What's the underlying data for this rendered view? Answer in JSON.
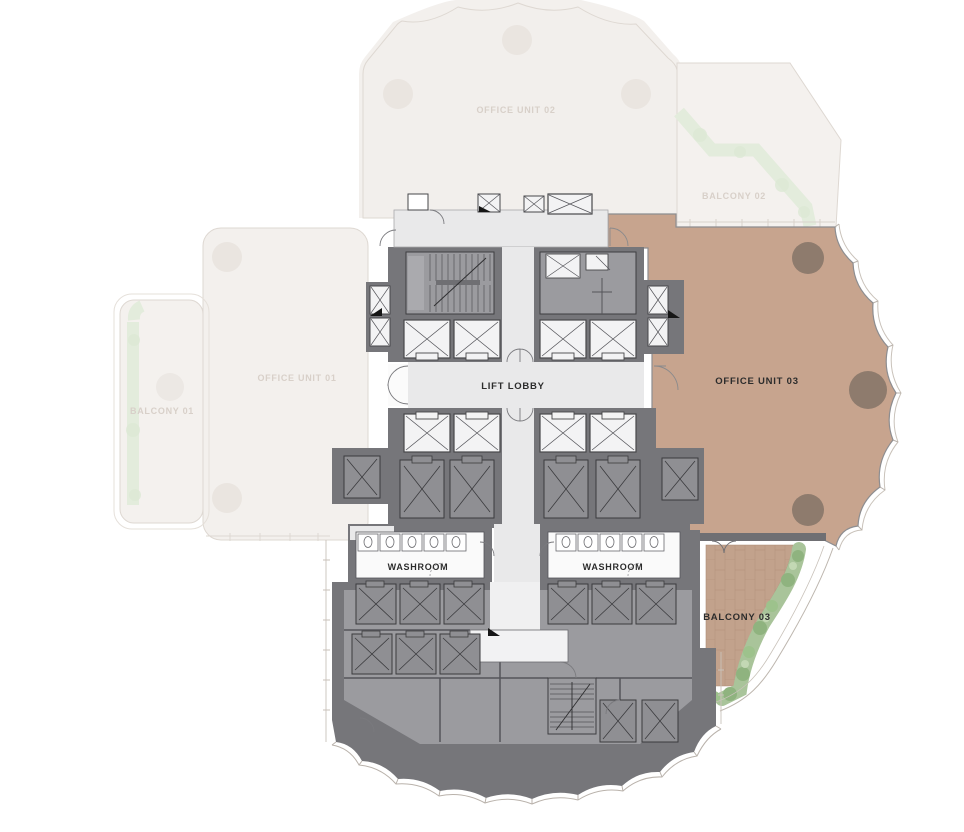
{
  "plan": {
    "type": "office-floor-plan",
    "rooms": {
      "office_unit_01": "OFFICE UNIT 01",
      "office_unit_02": "OFFICE UNIT 02",
      "office_unit_03": "OFFICE UNIT 03",
      "balcony_01": "BALCONY 01",
      "balcony_02": "BALCONY 02",
      "balcony_03": "BALCONY 03",
      "lift_lobby": "LIFT LOBBY",
      "washroom": "WASHROOM"
    },
    "highlighted_unit": "OFFICE UNIT 03",
    "colors": {
      "highlight_unit": "#c7a48e",
      "unit_column": "#8e7b6d",
      "balcony_tile": "#c2a28c",
      "plant_green": "#9cbb8d",
      "plant_green_dark": "#8fb37f",
      "core_wall": "#76767a",
      "core_room": "#9b9b9f",
      "lift_gray": "#8f8f93",
      "lift_white": "#f3f3f4",
      "corridor": "#e9e9ea",
      "washroom_floor": "#fafafa",
      "faded_fill": "#f3f0ed",
      "faded_stroke": "#ded8d2",
      "faded_label": "#d8d0c9",
      "label_text": "#2c2c2c",
      "facade_line": "#bdb6ae"
    }
  }
}
